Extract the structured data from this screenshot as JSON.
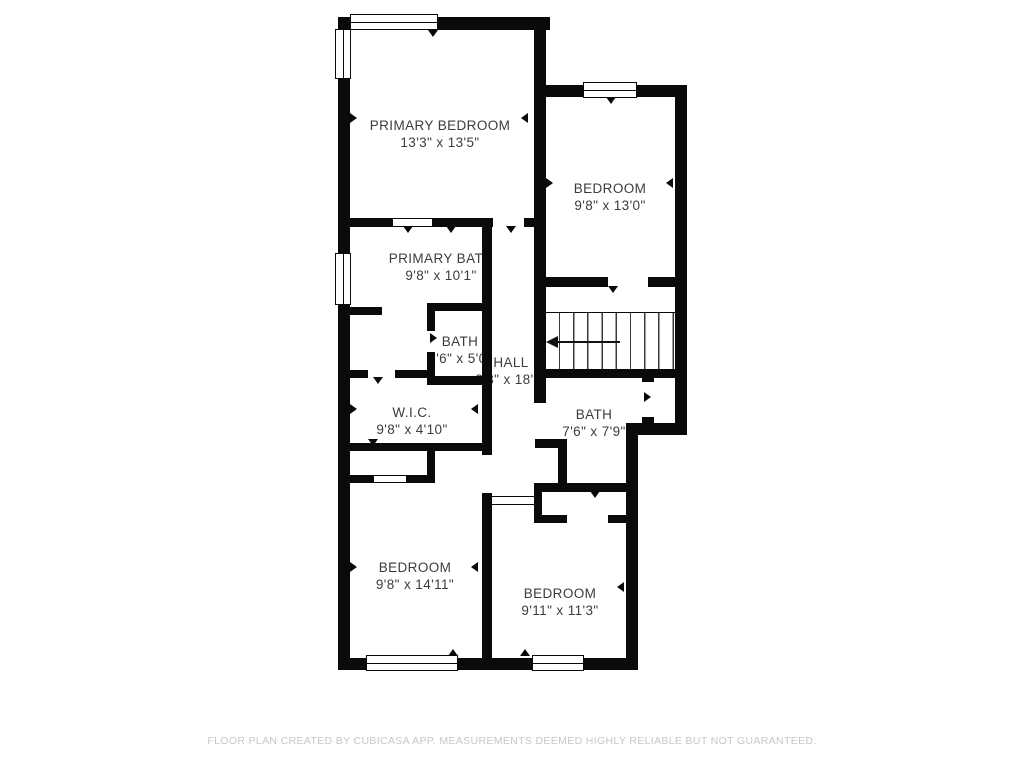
{
  "plan": {
    "rooms": [
      {
        "name": "PRIMARY BEDROOM",
        "dims": "13'3\" x 13'5\""
      },
      {
        "name": "BEDROOM",
        "dims": "9'8\" x 13'0\""
      },
      {
        "name": "PRIMARY BATH",
        "dims": "9'8\" x 10'1\""
      },
      {
        "name": "BATH",
        "dims": "3'6\" x 5'0\""
      },
      {
        "name": "HALL",
        "dims": "3'3\" x 18'1\""
      },
      {
        "name": "W.I.C.",
        "dims": "9'8\" x 4'10\""
      },
      {
        "name": "BATH",
        "dims": "7'6\" x 7'9\""
      },
      {
        "name": "BEDROOM",
        "dims": "9'8\" x 14'11\""
      },
      {
        "name": "BEDROOM",
        "dims": "9'11\" x 11'3\""
      }
    ],
    "stairs": {
      "direction": "left"
    }
  },
  "footer": {
    "disclaimer": "FLOOR PLAN CREATED BY CUBICASA APP. MEASUREMENTS DEEMED HIGHLY RELIABLE BUT NOT GUARANTEED."
  },
  "colors": {
    "wall": "#0a0a0a",
    "background": "#ffffff",
    "label": "#3c3c3c",
    "disclaimer": "#c7c7c7"
  }
}
